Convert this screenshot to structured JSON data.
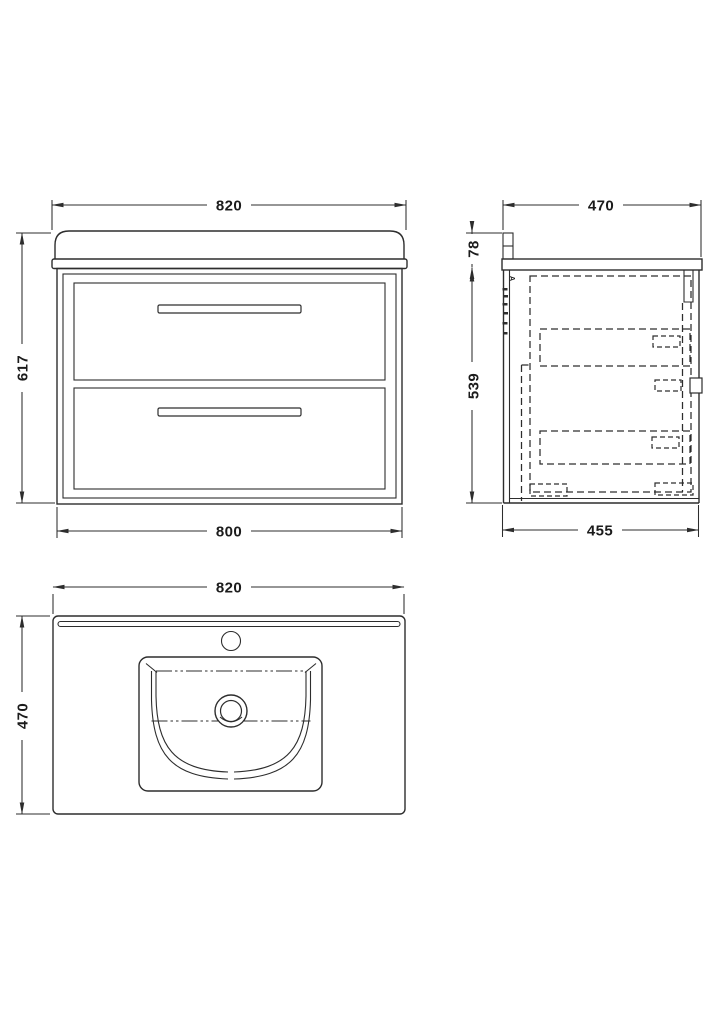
{
  "dimensions": {
    "front_width_top": "820",
    "front_height": "617",
    "front_width_bottom": "800",
    "side_depth_top": "470",
    "side_upstand_height": "78",
    "side_cabinet_height": "539",
    "side_depth_bottom": "455",
    "plan_width_top": "820",
    "plan_depth": "470"
  },
  "annotations": {
    "side_panel_note": "A"
  },
  "colors": {
    "line": "#2d2d2d",
    "text": "#1b1b1b",
    "background": "#ffffff"
  }
}
